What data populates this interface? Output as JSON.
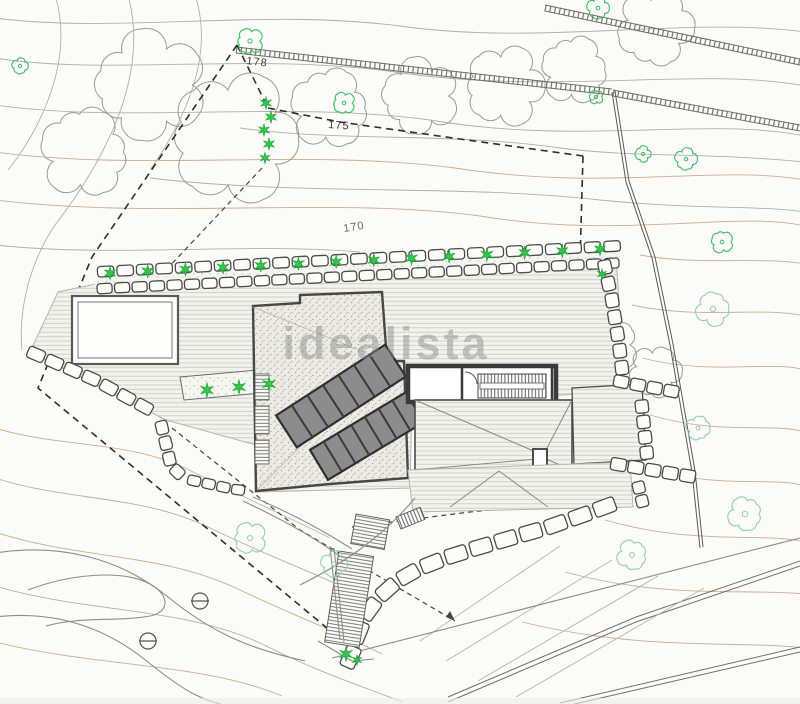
{
  "watermark": {
    "text": "idealista"
  },
  "plan": {
    "labels": [
      {
        "id": "contour-178",
        "text": "178"
      },
      {
        "id": "contour-175",
        "text": "175"
      },
      {
        "id": "contour-170",
        "text": "170"
      }
    ]
  },
  "colors": {
    "plant_green": "#2fca45",
    "plant_green_dark": "#1fa838",
    "tree_green_bright": "#3cbf62",
    "tree_green_pale": "#8fd3a4",
    "contour_gray": "#b0b0a8",
    "contour_tan": "#c9ae8e",
    "canopy_gray": "#9b9b93",
    "wall_dark": "#3a3a3a",
    "block_fill": "#fcfcf9",
    "block_stroke": "#4b4b4b",
    "watermark_gray": "#8c8c8c"
  }
}
